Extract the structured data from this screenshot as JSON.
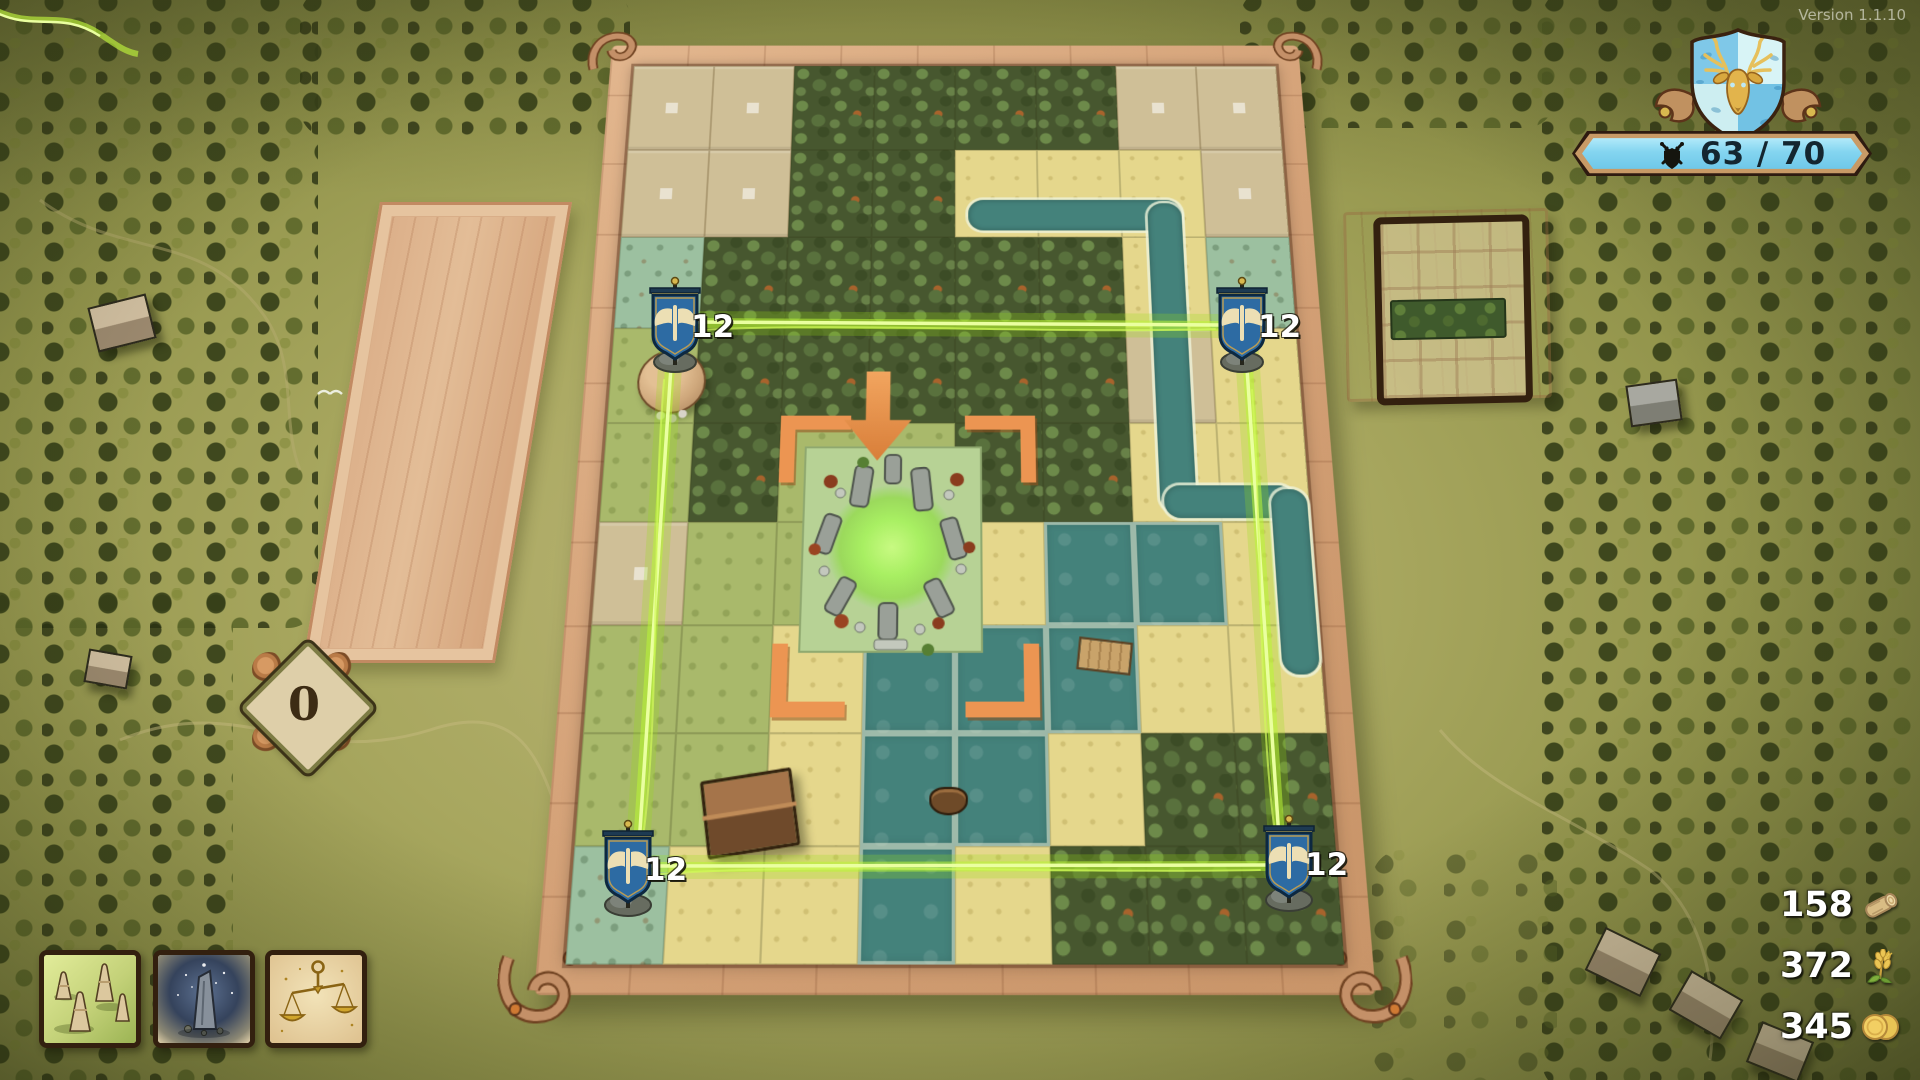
{
  "version_label": "Version 1.1.10",
  "hud": {
    "crest": "stag-shield-crest",
    "score_display": "63 / 70"
  },
  "flags": {
    "top_left": "12",
    "top_right": "12",
    "bottom_left": "12",
    "bottom_right": "12"
  },
  "plot_counter": "0",
  "resources": {
    "wood": "158",
    "wheat": "372",
    "gold": "345"
  },
  "cards": [
    {
      "name": "spire-mounds-card"
    },
    {
      "name": "monolith-card"
    },
    {
      "name": "scales-card"
    }
  ],
  "preview": {
    "content": "forest-hedge-tile"
  },
  "board": {
    "tile_rows": [
      "eeffffee",
      "eeffssse",
      "mfffffsm",
      "gfffffes",
      "gfggffss",
      "egggswws",
      "ggswwwss",
      "ggswwsff",
      "msswsfff"
    ],
    "legend": {
      "e": "empty-plot",
      "f": "forest",
      "g": "grass",
      "m": "meadow",
      "s": "sand",
      "w": "water"
    }
  },
  "palette": {
    "beam_green": "#b8f03c",
    "banner_blue": "#7fd2ee",
    "flag_blue": "#2d6ba3",
    "board_frame": "#d9a87f",
    "glow_green": "#a8ef62",
    "selection_orange": "#ec9552"
  }
}
